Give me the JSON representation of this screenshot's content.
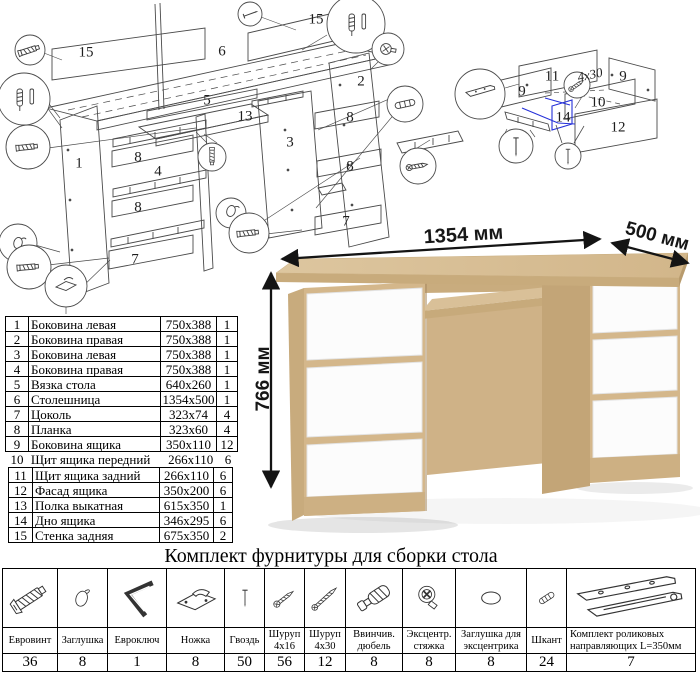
{
  "title": "Комплект фурнитуры для сборки стола",
  "desk": {
    "width_label": "1354 мм",
    "depth_label": "500 мм",
    "height_label": "766 мм"
  },
  "parts_table": {
    "rows": [
      {
        "num": "1",
        "name": "Боковина левая",
        "size": "750x388",
        "qty": "1"
      },
      {
        "num": "2",
        "name": "Боковина правая",
        "size": "750x388",
        "qty": "1"
      },
      {
        "num": "3",
        "name": "Боковина левая",
        "size": "750x388",
        "qty": "1"
      },
      {
        "num": "4",
        "name": "Боковина правая",
        "size": "750x388",
        "qty": "1"
      },
      {
        "num": "5",
        "name": "Вязка стола",
        "size": "640x260",
        "qty": "1"
      },
      {
        "num": "6",
        "name": "Столешница",
        "size": "1354x500",
        "qty": "1"
      },
      {
        "num": "7",
        "name": "Цоколь",
        "size": "323x74",
        "qty": "4"
      },
      {
        "num": "8",
        "name": "Планка",
        "size": "323x60",
        "qty": "4"
      },
      {
        "num": "9",
        "name": "Боковина ящика",
        "size": "350x110",
        "qty": "12"
      },
      {
        "num": "10",
        "name": "Щит ящика передний",
        "size": "266x110",
        "qty": "6"
      },
      {
        "num": "11",
        "name": "Щит ящика задний",
        "size": "266x110",
        "qty": "6"
      },
      {
        "num": "12",
        "name": "Фасад ящика",
        "size": "350x200",
        "qty": "6"
      },
      {
        "num": "13",
        "name": "Полка выкатная",
        "size": "615x350",
        "qty": "1"
      },
      {
        "num": "14",
        "name": "Дно ящика",
        "size": "346x295",
        "qty": "6"
      },
      {
        "num": "15",
        "name": "Стенка задняя",
        "size": "675x350",
        "qty": "2"
      }
    ]
  },
  "main_diagram": {
    "labels": [
      {
        "t": "15",
        "x": 86,
        "y": 53
      },
      {
        "t": "6",
        "x": 222,
        "y": 52
      },
      {
        "t": "15",
        "x": 316,
        "y": 20
      },
      {
        "t": "5",
        "x": 207,
        "y": 101
      },
      {
        "t": "13",
        "x": 245,
        "y": 117
      },
      {
        "t": "3",
        "x": 290,
        "y": 143
      },
      {
        "t": "1",
        "x": 79,
        "y": 164
      },
      {
        "t": "8",
        "x": 138,
        "y": 158
      },
      {
        "t": "4",
        "x": 158,
        "y": 172
      },
      {
        "t": "8",
        "x": 138,
        "y": 208
      },
      {
        "t": "7",
        "x": 135,
        "y": 260
      },
      {
        "t": "2",
        "x": 361,
        "y": 82
      },
      {
        "t": "8",
        "x": 350,
        "y": 118
      },
      {
        "t": "8",
        "x": 350,
        "y": 167
      },
      {
        "t": "7",
        "x": 346,
        "y": 222
      }
    ]
  },
  "drawer_diagram": {
    "labels": [
      {
        "t": "11",
        "x": 552,
        "y": 77
      },
      {
        "t": "9",
        "x": 623,
        "y": 77
      },
      {
        "t": "9",
        "x": 522,
        "y": 92
      },
      {
        "t": "10",
        "x": 598,
        "y": 103
      },
      {
        "t": "14",
        "x": 563,
        "y": 118
      },
      {
        "t": "12",
        "x": 618,
        "y": 128
      },
      {
        "t": "4x30",
        "x": 590,
        "y": 75,
        "variant": "handwritten"
      }
    ]
  },
  "hardware_table": {
    "columns": [
      {
        "icon": "confirmat-screw-icon",
        "label": "Евровинт",
        "qty": "36",
        "width": 54
      },
      {
        "icon": "cap-icon",
        "label": "Заглушка",
        "qty": "8",
        "width": 50
      },
      {
        "icon": "hex-key-icon",
        "label": "Евроключ",
        "qty": "1",
        "width": 59
      },
      {
        "icon": "foot-icon",
        "label": "Ножка",
        "qty": "8",
        "width": 58
      },
      {
        "icon": "nail-icon",
        "label": "Гвоздь",
        "qty": "50",
        "width": 40
      },
      {
        "icon": "screw-4x16-icon",
        "label": "Шуруп 4х16",
        "qty": "56",
        "width": 40
      },
      {
        "icon": "screw-4x30-icon",
        "label": "Шуруп 4х30",
        "qty": "12",
        "width": 41
      },
      {
        "icon": "screw-in-dowel-icon",
        "label": "Ввинчив. дюбель",
        "qty": "8",
        "width": 57
      },
      {
        "icon": "cam-lock-icon",
        "label": "Эксцентр. стяжка",
        "qty": "8",
        "width": 53
      },
      {
        "icon": "cam-cap-icon",
        "label": "Заглушка для эксцентрика",
        "qty": "8",
        "width": 71
      },
      {
        "icon": "wood-dowel-icon",
        "label": "Шкант",
        "qty": "24",
        "width": 40
      },
      {
        "icon": "drawer-slides-icon",
        "label": "Комплект роликовых направляющих L=350мм",
        "qty": "7",
        "width": 0
      }
    ]
  }
}
